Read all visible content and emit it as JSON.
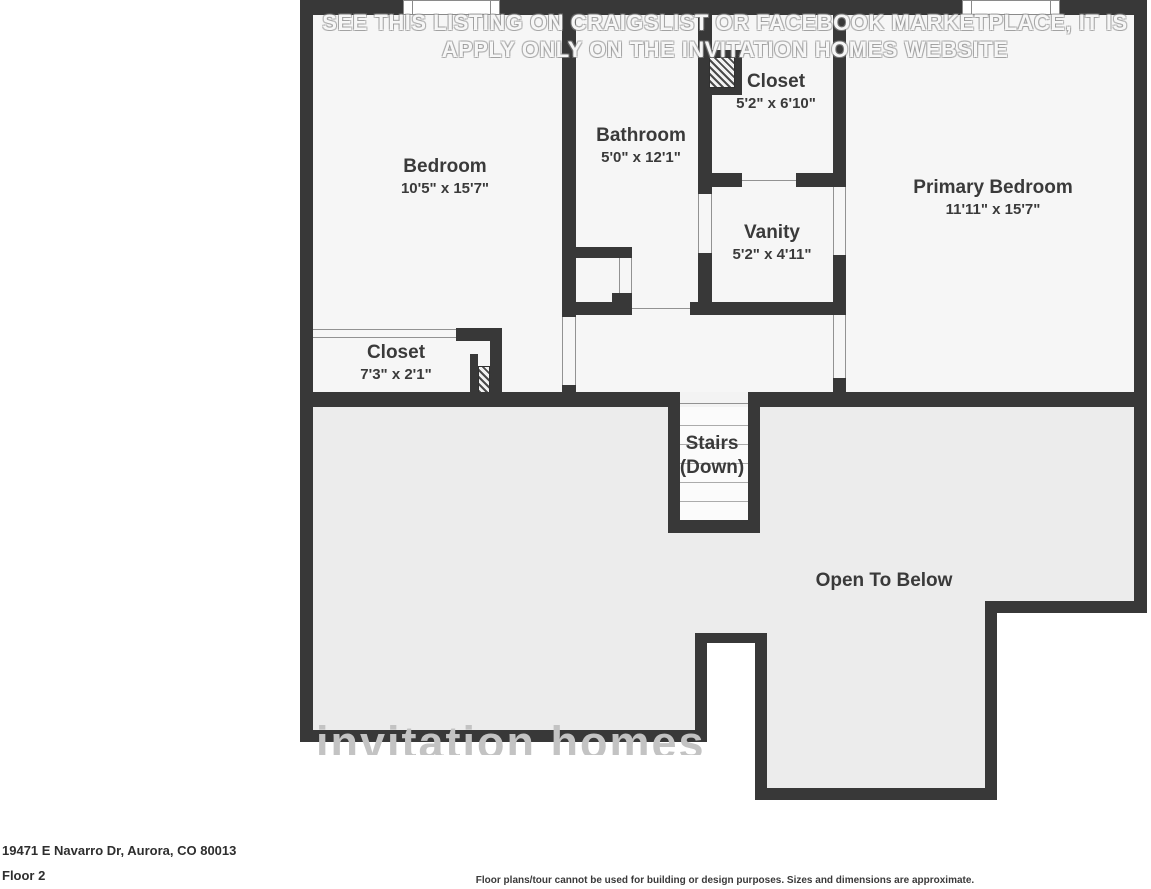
{
  "plan": {
    "rooms": [
      {
        "name": "Bedroom",
        "dims": "10'5\" x 15'7\""
      },
      {
        "name": "Bathroom",
        "dims": "5'0\" x 12'1\""
      },
      {
        "name": "Closet",
        "dims": "5'2\" x 6'10\""
      },
      {
        "name": "Primary Bedroom",
        "dims": "11'11\" x 15'7\""
      },
      {
        "name": "Vanity",
        "dims": "5'2\" x 4'11\""
      },
      {
        "name": "Closet",
        "dims": "7'3\" x 2'1\""
      }
    ],
    "stairs_line1": "Stairs",
    "stairs_line2": "(Down)",
    "open_to_below": "Open To Below"
  },
  "watermark": {
    "line1": "SEE THIS LISTING ON CRAIGSLIST OR FACEBOOK MARKETPLACE, IT IS",
    "line2": "APPLY ONLY ON THE INVITATION HOMES WEBSITE",
    "brand": "invitation homes"
  },
  "footer": {
    "address": "19471 E Navarro Dr, Aurora, CO 80013",
    "floor_label": "Floor 2",
    "disclaimer": "Floor plans/tour cannot be used for building or design purposes. Sizes and dimensions are approximate."
  },
  "colors": {
    "wall": "#383838",
    "room_fill": "#f6f6f6",
    "lower_fill": "#ececec"
  }
}
